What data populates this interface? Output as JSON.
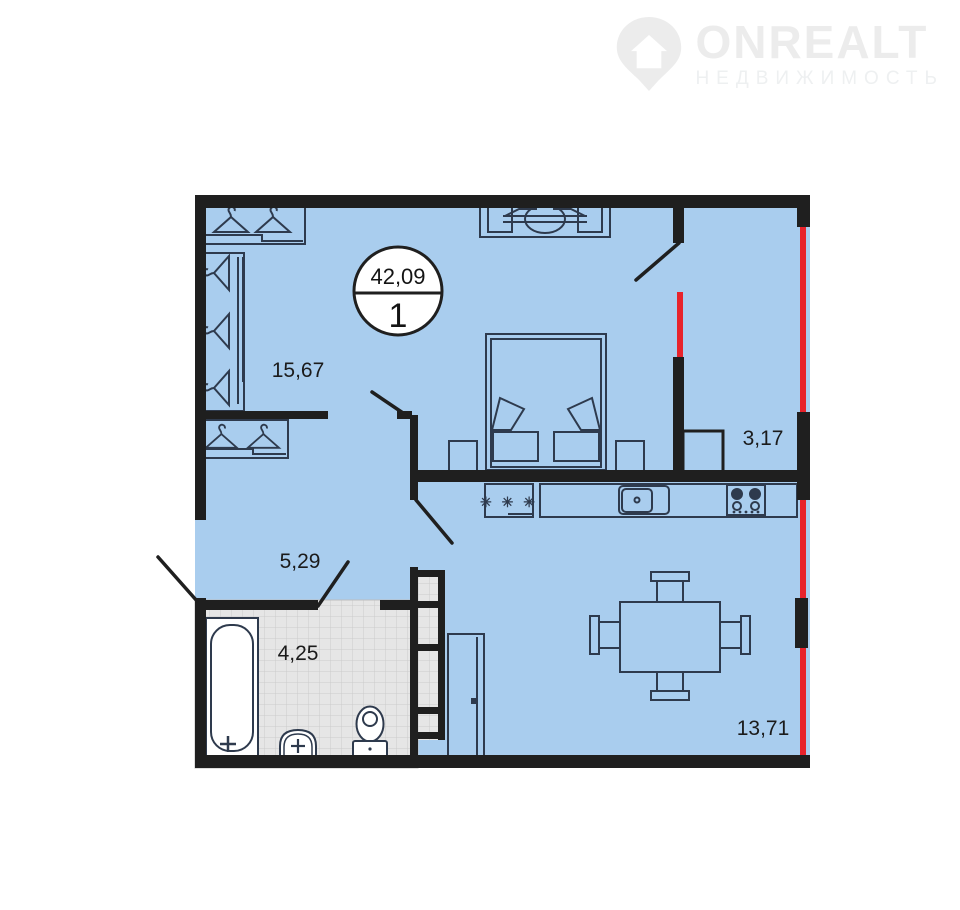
{
  "logo": {
    "brand": "ONREALT",
    "subtitle": "НЕДВИЖИМОСТЬ"
  },
  "plan": {
    "unit_badge": {
      "total_area": "42,09",
      "unit_label": "1"
    },
    "room_areas": {
      "bedroom": "15,67",
      "loggia": "3,17",
      "hallway": "5,29",
      "bathroom": "4,25",
      "kitchen_living": "13,71"
    },
    "fridge_freezer_symbol": "✳ ✳ ✳",
    "colors": {
      "room_fill": "#a9cdee",
      "wall": "#1f1f1f",
      "window_line": "#e8232b",
      "bathroom_tile": "#e6e6e6",
      "furniture_outline": "#2e3a4d",
      "watermark": "#ececec"
    }
  }
}
